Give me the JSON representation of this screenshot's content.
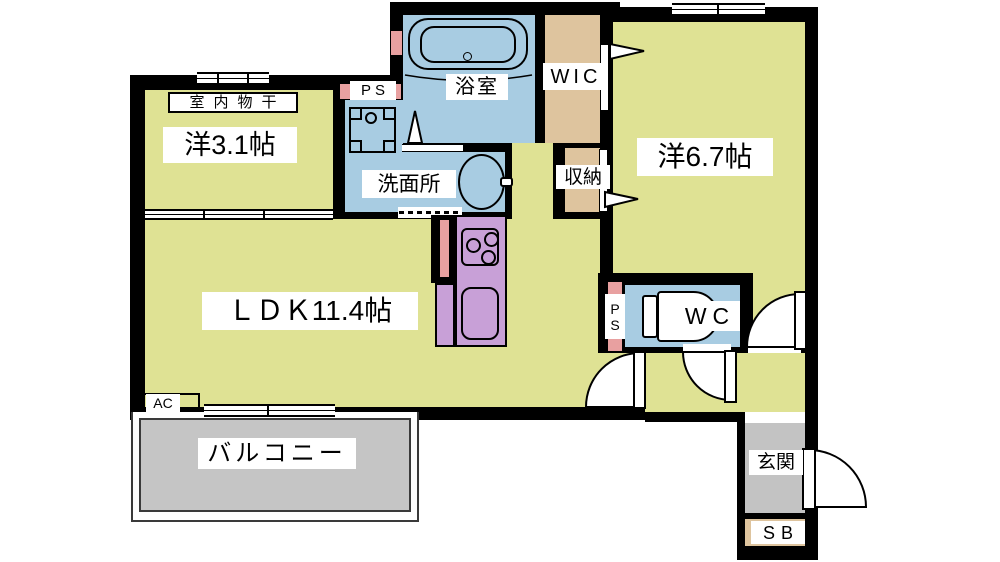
{
  "floorplan": {
    "title": "1LDK+WIC apartment floor plan",
    "labels": {
      "indoor_drying": "室内物干",
      "western_room_small": "洋3.1帖",
      "bathroom": "浴室",
      "wic": "WIC",
      "storage": "収納",
      "western_room_large": "洋6.7帖",
      "washroom": "洗面所",
      "ldk": "ＬＤＫ11.4帖",
      "wc": "WC",
      "pipe_space_top": "PS",
      "pipe_space_wc": "PS",
      "entrance": "玄関",
      "shoe_box": "SB",
      "balcony": "バルコニー",
      "air_conditioner": "AC"
    },
    "colors": {
      "wall": "#000000",
      "room_yellow": "#dfe294",
      "water_blue": "#a8cce2",
      "closet_tan": "#dec49e",
      "kitchen_purple": "#c8a0d7",
      "pipe_pink": "#e8a0a0",
      "balcony_gray": "#c5c5c5",
      "entrance_gray": "#c3c3c3"
    },
    "fixtures": [
      "bathtub",
      "washing-machine-pan",
      "wash-basin",
      "toilet",
      "gas-stove",
      "kitchen-sink",
      "refrigerator-space",
      "entrance-door",
      "swing-doors",
      "folding-door",
      "sliding-windows"
    ]
  }
}
